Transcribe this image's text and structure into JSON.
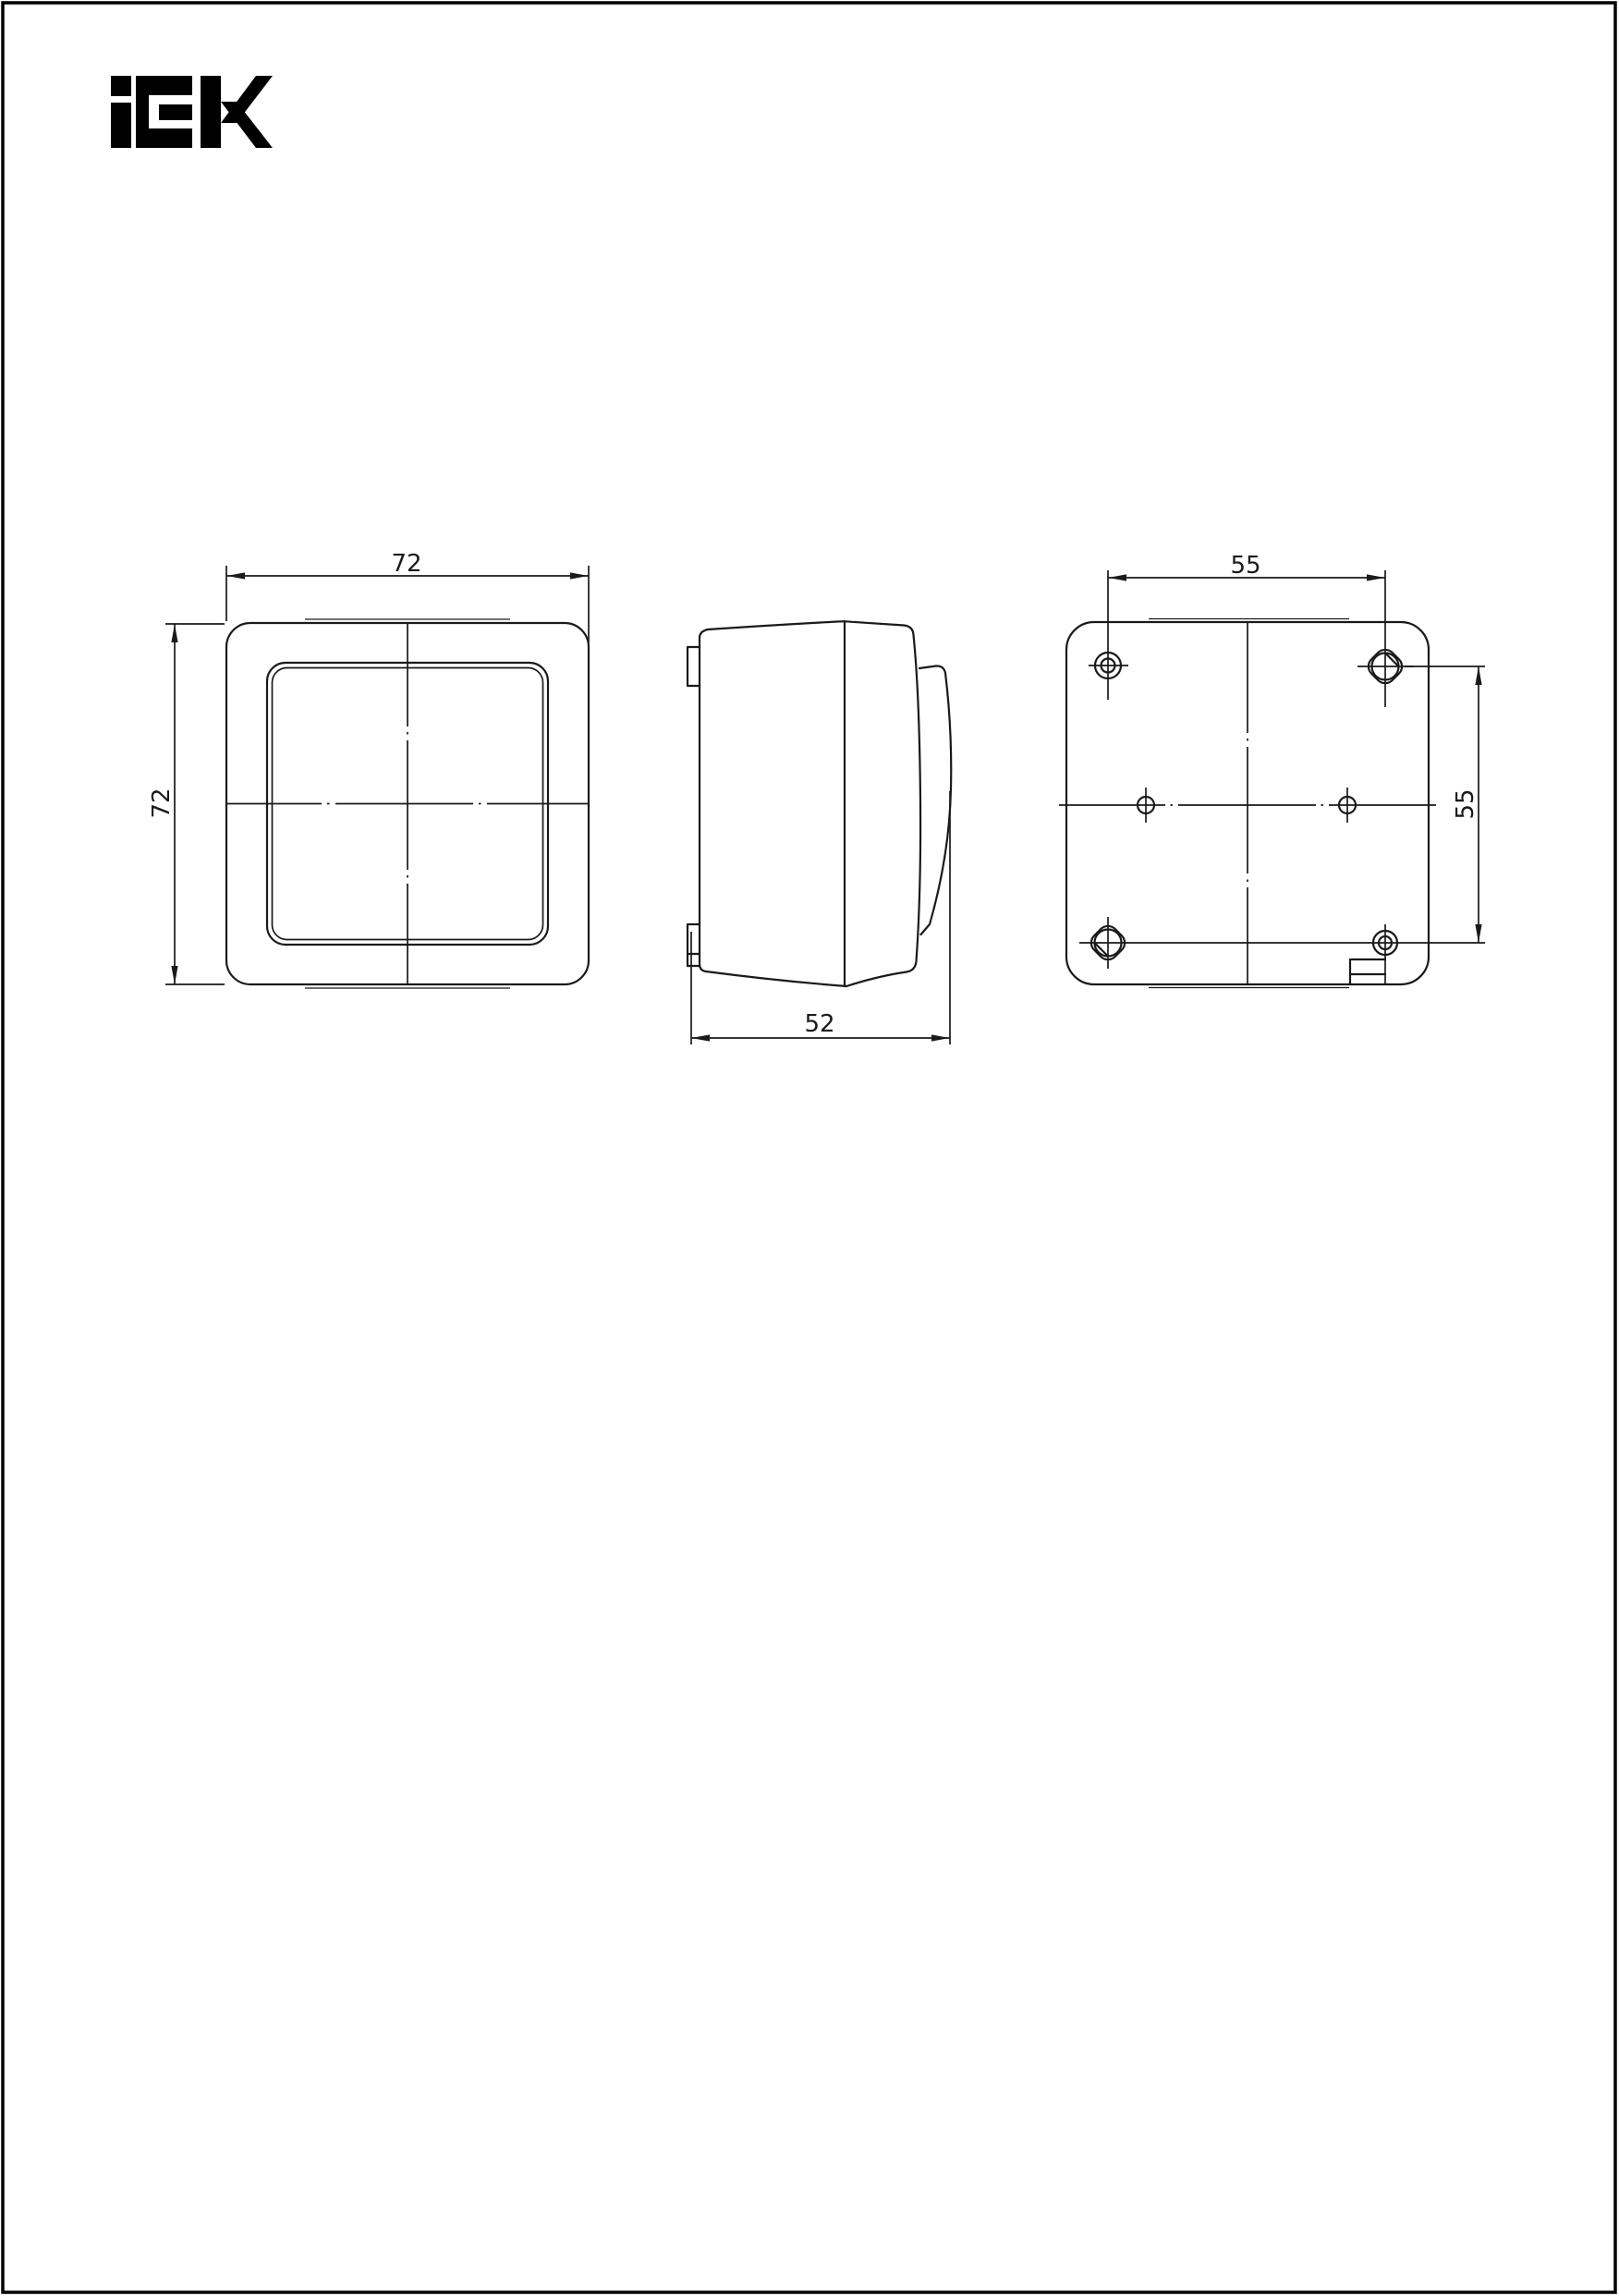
{
  "document": {
    "kind": "technical dimensional drawing",
    "brand_logo": "IEK"
  },
  "colors": {
    "background": "#ffffff",
    "line": "#1a1a1a",
    "logo": "#000000",
    "page_border": "#000000"
  },
  "views": {
    "front": {
      "label_width": "72",
      "label_height": "72"
    },
    "side": {
      "label_depth": "52"
    },
    "back": {
      "label_spacing_horizontal": "55",
      "label_spacing_vertical": "55"
    }
  }
}
